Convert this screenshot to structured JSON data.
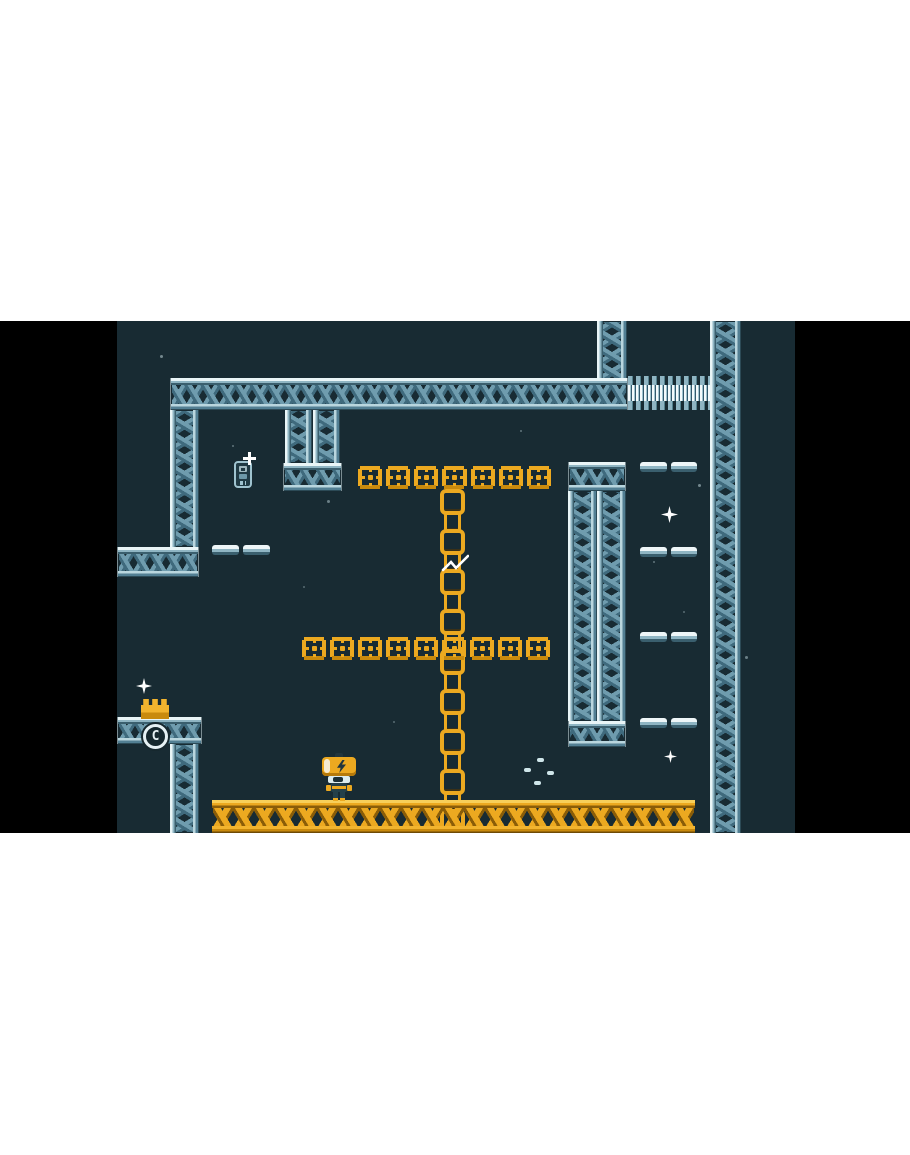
{
  "meta": {
    "description": "retro pixel-art platformer game screenshot, letterboxed game frame",
    "letterbox_color": "#000000",
    "page_background": "#ffffff"
  },
  "palette": {
    "game_background": "#182b33",
    "steel_light": "#e9f5f7",
    "steel_mid": "#8fb5c3",
    "steel_brace": "#4f7e92",
    "steel_dark": "#3a5f6e",
    "orange_bright": "#eca920",
    "orange_light": "#f7cf5a",
    "orange_dark": "#8a5d08",
    "sparkle_white": "#ffffff"
  },
  "scene": {
    "frame": {
      "x": 0,
      "y": 321,
      "w": 910,
      "h": 512
    },
    "viewport": {
      "x": 117,
      "y": 0,
      "w": 678,
      "h": 512
    },
    "badge": {
      "label": "C"
    },
    "structures": [
      {
        "type": "girder-v",
        "name": "girder-top-right-column",
        "x": 480,
        "y": 0,
        "w": 30,
        "h": 58
      },
      {
        "type": "girder-v",
        "name": "girder-right-wall",
        "x": 593,
        "y": 0,
        "w": 31,
        "h": 512
      },
      {
        "type": "girder-h",
        "name": "girder-top-span",
        "x": 53,
        "y": 57,
        "w": 458,
        "h": 32
      },
      {
        "type": "conveyor",
        "name": "conveyor-bridge",
        "x": 511,
        "y": 55,
        "w": 82,
        "h": 34
      },
      {
        "type": "girder-v",
        "name": "girder-left-upper",
        "x": 53,
        "y": 89,
        "w": 29,
        "h": 137
      },
      {
        "type": "girder-v",
        "name": "girder-mid-column-a",
        "x": 168,
        "y": 89,
        "w": 27,
        "h": 53
      },
      {
        "type": "girder-v",
        "name": "girder-mid-column-b",
        "x": 196,
        "y": 89,
        "w": 27,
        "h": 53
      },
      {
        "type": "girder-h",
        "name": "girder-mid-cap",
        "x": 166,
        "y": 142,
        "w": 59,
        "h": 28
      },
      {
        "type": "girder-h",
        "name": "girder-right-mid-cap-top",
        "x": 451,
        "y": 141,
        "w": 58,
        "h": 29
      },
      {
        "type": "girder-v",
        "name": "girder-right-mid-column-a",
        "x": 451,
        "y": 170,
        "w": 29,
        "h": 230
      },
      {
        "type": "girder-v",
        "name": "girder-right-mid-column-b",
        "x": 480,
        "y": 170,
        "w": 29,
        "h": 230
      },
      {
        "type": "girder-h",
        "name": "girder-right-mid-cap-bottom",
        "x": 451,
        "y": 400,
        "w": 58,
        "h": 26
      },
      {
        "type": "girder-h",
        "name": "girder-left-ledge",
        "x": 0,
        "y": 226,
        "w": 82,
        "h": 30
      },
      {
        "type": "beam",
        "name": "pipe-ledge-left",
        "x": 95,
        "y": 224,
        "w": 58,
        "h": 10
      },
      {
        "type": "beam",
        "name": "pipe-ledge-right-1",
        "x": 523,
        "y": 141,
        "w": 57,
        "h": 10
      },
      {
        "type": "beam",
        "name": "pipe-ledge-right-2",
        "x": 523,
        "y": 226,
        "w": 57,
        "h": 10
      },
      {
        "type": "beam",
        "name": "pipe-ledge-right-3",
        "x": 523,
        "y": 311,
        "w": 57,
        "h": 10
      },
      {
        "type": "beam",
        "name": "pipe-ledge-right-4",
        "x": 523,
        "y": 397,
        "w": 57,
        "h": 10
      },
      {
        "type": "chain",
        "name": "hanging-chain",
        "x": 326,
        "y": 168,
        "w": 19,
        "h": 312
      },
      {
        "type": "platform",
        "name": "orange-platform-upper",
        "x": 239,
        "y": 143,
        "w": 197,
        "h": 27,
        "tiles": 7
      },
      {
        "type": "platform",
        "name": "orange-platform-lower",
        "x": 183,
        "y": 314,
        "w": 252,
        "h": 27,
        "tiles": 9
      },
      {
        "type": "girder-h",
        "name": "girder-crown-pedestal",
        "x": 0,
        "y": 396,
        "w": 85,
        "h": 27
      },
      {
        "type": "girder-v",
        "name": "girder-left-lower",
        "x": 53,
        "y": 423,
        "w": 29,
        "h": 89
      },
      {
        "type": "floor",
        "name": "orange-floor",
        "x": 95,
        "y": 479,
        "w": 483,
        "h": 33
      },
      {
        "type": "crown",
        "name": "crown-item",
        "x": 24,
        "y": 378,
        "w": 28,
        "h": 20
      },
      {
        "type": "badge",
        "name": "checkpoint-badge",
        "x": 26,
        "y": 403,
        "w": 25,
        "h": 25
      },
      {
        "type": "robot",
        "name": "player-robot",
        "x": 203,
        "y": 432,
        "w": 38,
        "h": 48
      },
      {
        "type": "chip",
        "name": "collectible-chip",
        "x": 117,
        "y": 140,
        "w": 18,
        "h": 27
      },
      {
        "type": "plus",
        "name": "chip-sparkle",
        "x": 126,
        "y": 131,
        "w": 13,
        "h": 13
      },
      {
        "type": "slash",
        "name": "cut-cursor",
        "x": 324,
        "y": 232,
        "w": 28,
        "h": 21
      },
      {
        "type": "star",
        "name": "sparkle-crown",
        "x": 19,
        "y": 357,
        "w": 16,
        "h": 16
      },
      {
        "type": "star",
        "name": "sparkle-right",
        "x": 544,
        "y": 185,
        "w": 17,
        "h": 17
      },
      {
        "type": "star",
        "name": "sparkle-bottom-right",
        "x": 547,
        "y": 429,
        "w": 13,
        "h": 13
      },
      {
        "type": "ring",
        "name": "particle-ring",
        "x": 421,
        "y": 451,
        "dashes": [
          [
            2,
            -12
          ],
          [
            -11,
            -2
          ],
          [
            12,
            1
          ],
          [
            -1,
            11
          ]
        ]
      },
      {
        "type": "dot",
        "name": "bg-dot",
        "x": 43,
        "y": 34,
        "w": 3,
        "o": 0.5
      },
      {
        "type": "dot",
        "name": "bg-dot",
        "x": 115,
        "y": 124,
        "w": 2,
        "o": 0.4
      },
      {
        "type": "dot",
        "name": "bg-dot",
        "x": 210,
        "y": 179,
        "w": 3,
        "o": 0.45
      },
      {
        "type": "dot",
        "name": "bg-dot",
        "x": 403,
        "y": 109,
        "w": 2,
        "o": 0.4
      },
      {
        "type": "dot",
        "name": "bg-dot",
        "x": 500,
        "y": 27,
        "w": 2,
        "o": 0.4
      },
      {
        "type": "dot",
        "name": "bg-dot",
        "x": 581,
        "y": 163,
        "w": 3,
        "o": 0.5
      },
      {
        "type": "dot",
        "name": "bg-dot",
        "x": 536,
        "y": 240,
        "w": 2,
        "o": 0.4
      },
      {
        "type": "dot",
        "name": "bg-dot",
        "x": 566,
        "y": 290,
        "w": 2,
        "o": 0.35
      },
      {
        "type": "dot",
        "name": "bg-dot",
        "x": 628,
        "y": 335,
        "w": 3,
        "o": 0.45
      },
      {
        "type": "dot",
        "name": "bg-dot",
        "x": 186,
        "y": 265,
        "w": 2,
        "o": 0.35
      },
      {
        "type": "dot",
        "name": "bg-dot",
        "x": 276,
        "y": 400,
        "w": 2,
        "o": 0.35
      }
    ]
  }
}
